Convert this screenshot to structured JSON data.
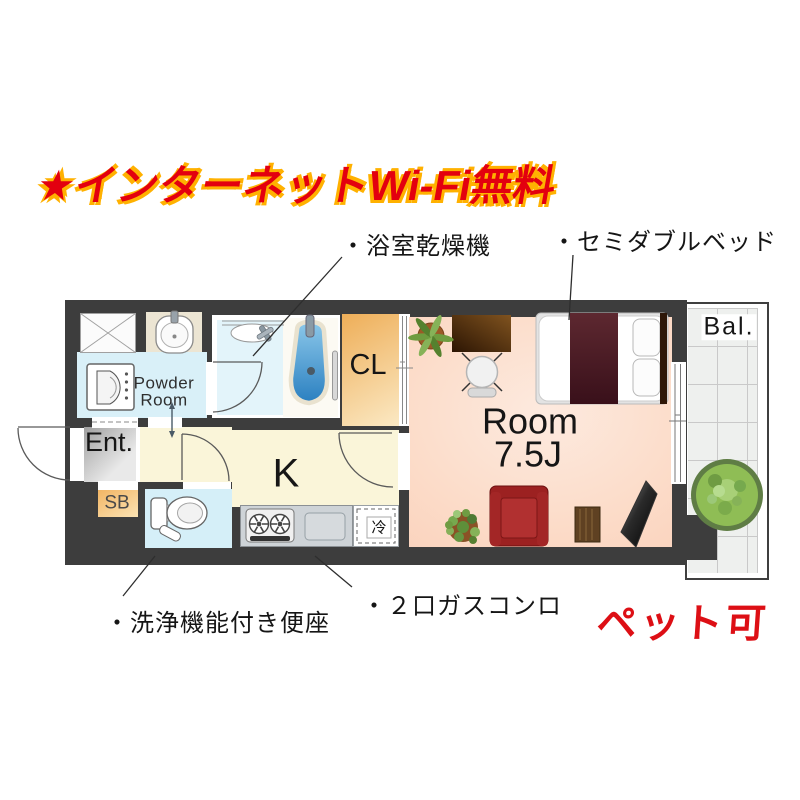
{
  "promo": {
    "internet_free": "★インターネットWi-Fi無料",
    "pet_ok": "ペット可"
  },
  "callouts": {
    "bath_dryer": "・浴室乾燥機",
    "semi_double_bed": "・セミダブルベッド",
    "washlet": "・洗浄機能付き便座",
    "gas_stove": "・２口ガスコンロ"
  },
  "rooms": {
    "powder_room": "Powder Room",
    "entrance": "Ent.",
    "shoe_box": "SB",
    "closet": "CL",
    "kitchen": "K",
    "fridge": "冷",
    "main_room": "Room",
    "main_room_size": "7.5J",
    "balcony": "Bal."
  },
  "palette": {
    "wall": "#3d3d3d",
    "wet-floor": "#d9f0f8",
    "bath-floor": "#e3f4fa",
    "kitchen-floor": "#faf5d9",
    "room-floor": "#fcdcc9",
    "room-floor-light": "#fdeadf",
    "closet-orange": "#eeae58",
    "closet-orange-light": "#fbe9c4",
    "accent-red": "#e3000f",
    "accent-orange": "#ffb100",
    "pet-red": "#dd0f15",
    "tub-blue": "#2f86c4",
    "sofa-red": "#9c2121",
    "bed-maroon": "#4a1a22"
  }
}
